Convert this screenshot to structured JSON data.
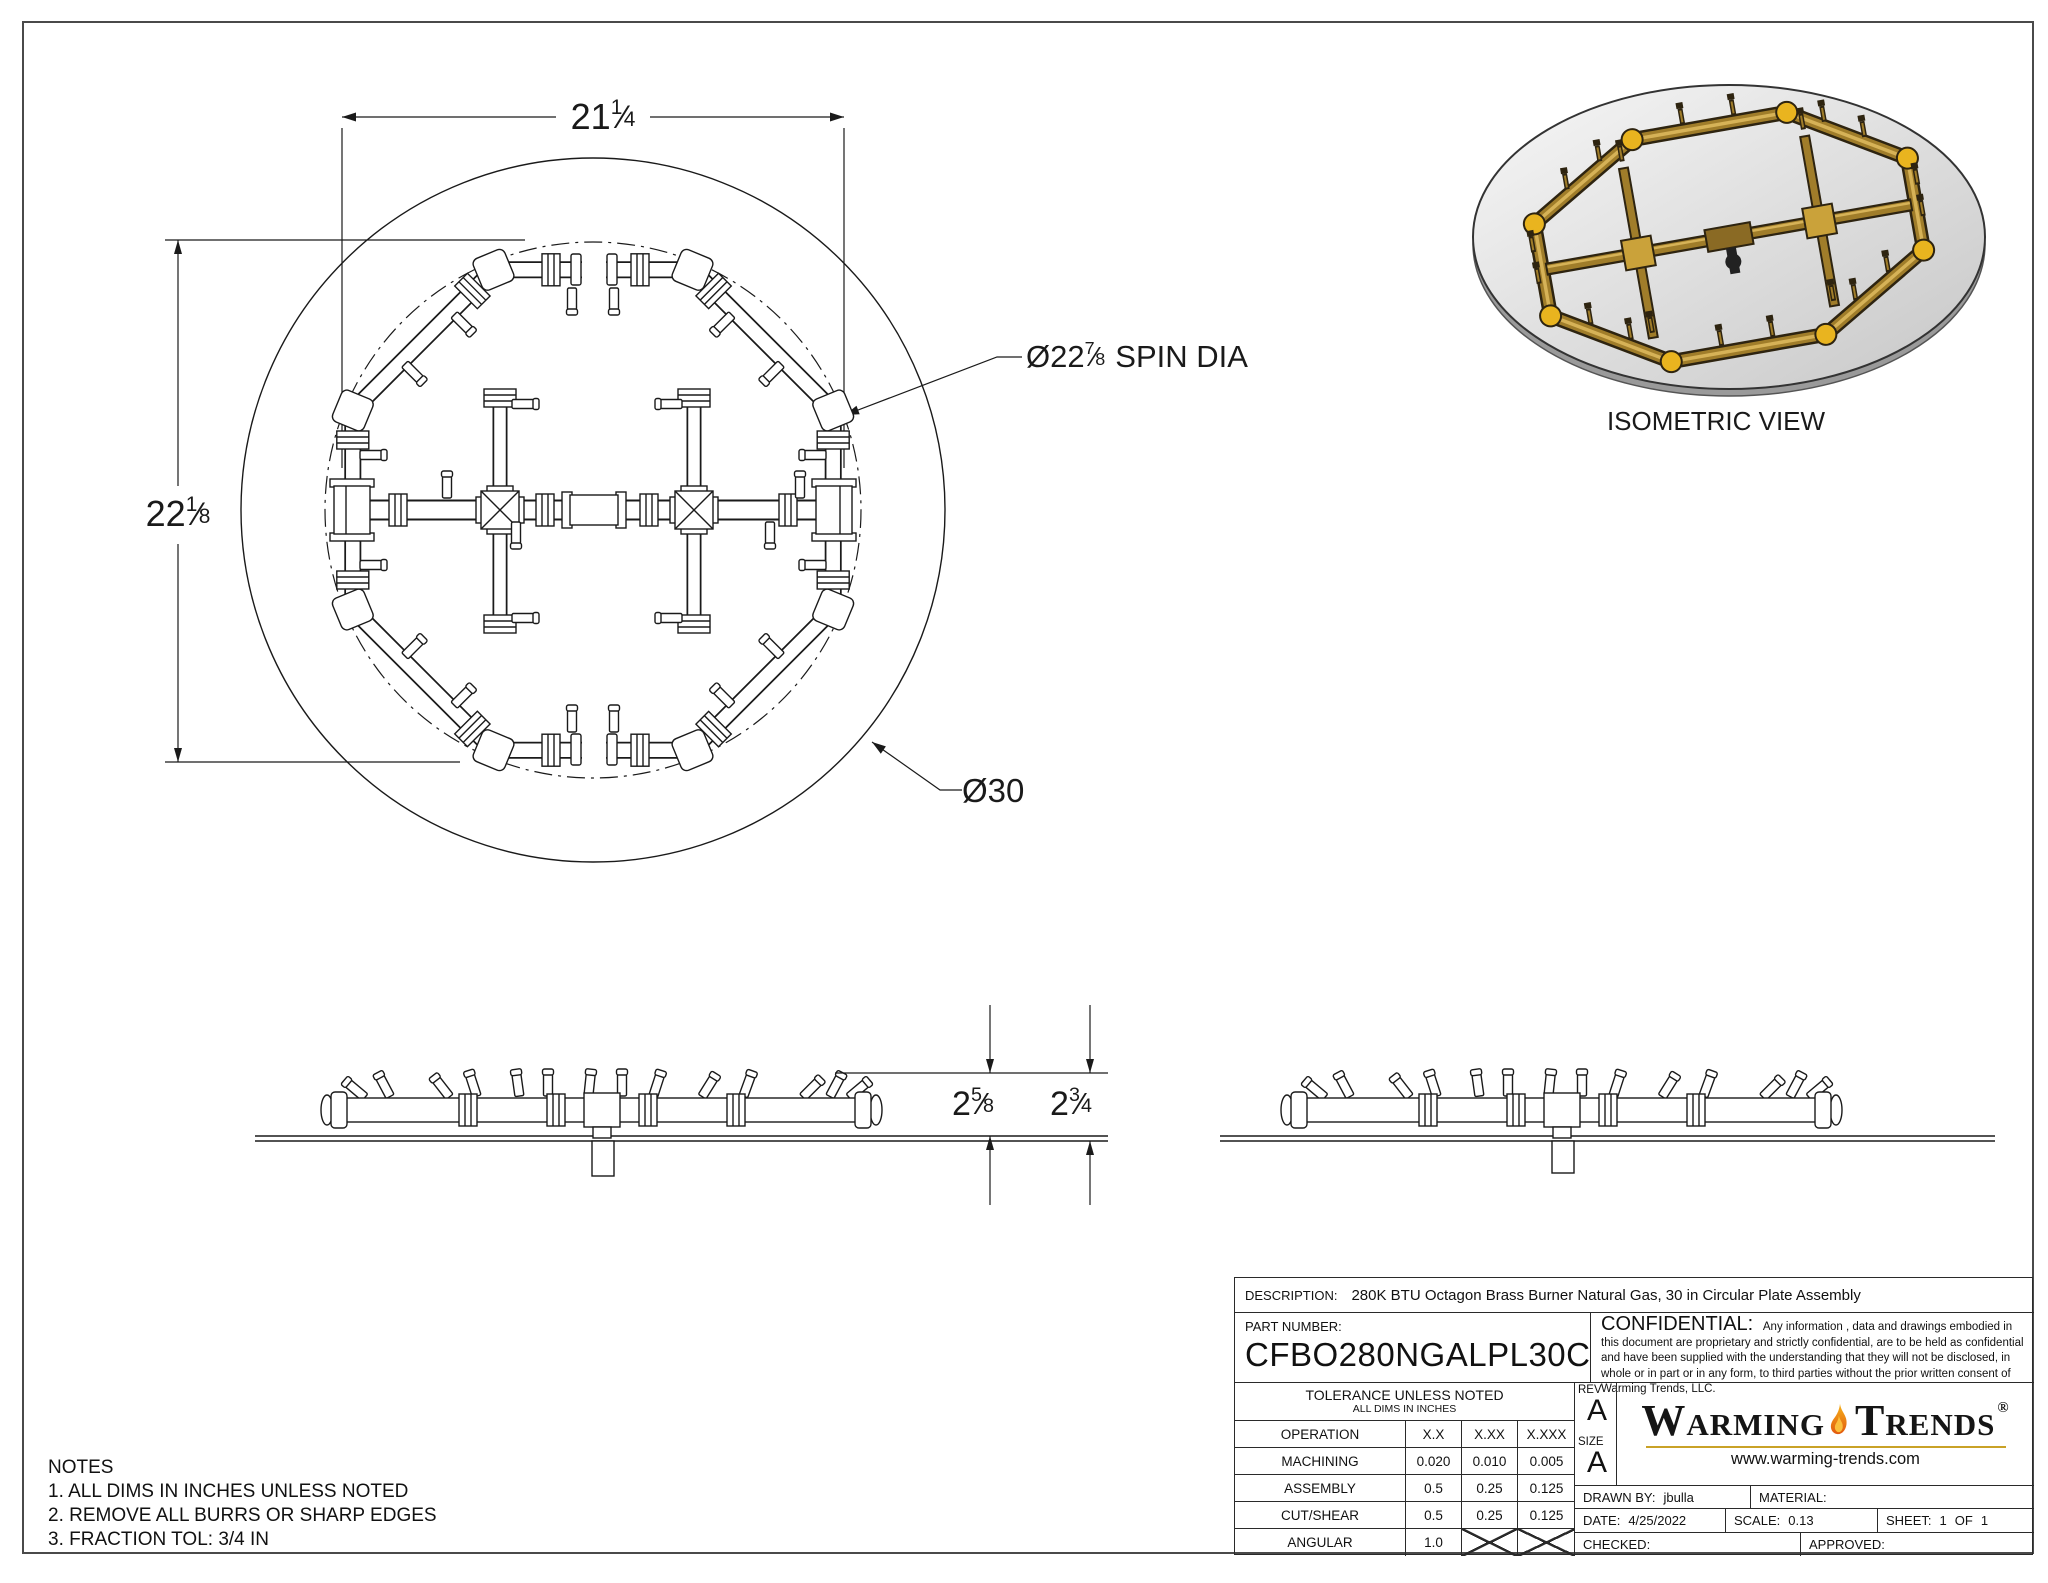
{
  "sheet": {
    "isometric_label": "ISOMETRIC VIEW",
    "notes": {
      "title": "NOTES",
      "items": [
        "1. ALL DIMS IN INCHES UNLESS NOTED",
        "2. REMOVE ALL BURRS OR SHARP EDGES",
        "3. FRACTION TOL: 3/4 IN"
      ]
    }
  },
  "dimensions": {
    "frac_slash": "⁄",
    "width": {
      "whole": "21",
      "num": "1",
      "den": "4"
    },
    "height": {
      "whole": "22",
      "num": "1",
      "den": "8"
    },
    "spin": {
      "prefix": "Ø",
      "whole": "22",
      "num": "7",
      "den": "8",
      "suffix": "SPIN DIA"
    },
    "plate": "Ø30",
    "burner_height": {
      "whole": "2",
      "num": "5",
      "den": "8"
    },
    "overall_height": {
      "whole": "2",
      "num": "3",
      "den": "4"
    }
  },
  "title_block": {
    "description_label": "DESCRIPTION:",
    "description": "280K BTU Octagon Brass Burner Natural Gas, 30 in Circular Plate Assembly",
    "part_number_label": "PART NUMBER:",
    "part_number": "CFBO280NGALPL30C",
    "confidential_label": "CONFIDENTIAL:",
    "confidential_text": "Any information , data and drawings embodied in this document are proprietary and strictly confidential, are to be held as confidential and have been supplied with the understanding that they will not be disclosed, in whole or in part or in any form, to third parties without the prior written consent of Warming Trends, LLC.",
    "tolerance": {
      "title": "TOLERANCE UNLESS NOTED",
      "subtitle": "ALL DIMS IN INCHES",
      "columns": [
        "OPERATION",
        "X.X",
        "X.XX",
        "X.XXX"
      ],
      "rows": [
        {
          "label": "MACHINING",
          "values": [
            "0.020",
            "0.010",
            "0.005"
          ]
        },
        {
          "label": "ASSEMBLY",
          "values": [
            "0.5",
            "0.25",
            "0.125"
          ]
        },
        {
          "label": "CUT/SHEAR",
          "values": [
            "0.5",
            "0.25",
            "0.125"
          ]
        },
        {
          "label": "ANGULAR",
          "values": [
            "1.0",
            "",
            ""
          ]
        }
      ]
    },
    "rev_label": "REV",
    "rev": "A",
    "size_label": "SIZE",
    "size": "A",
    "logo": {
      "word1": "Warming",
      "word2": "Trends",
      "registered": "®",
      "website": "www.warming-trends.com"
    },
    "drawn_by_label": "DRAWN BY:",
    "drawn_by": "jbulla",
    "material_label": "MATERIAL:",
    "material": "",
    "date_label": "DATE:",
    "date": "4/25/2022",
    "scale_label": "SCALE:",
    "scale": "0.13",
    "sheet_label": "SHEET:",
    "sheet_num": "1",
    "sheet_of": "OF",
    "sheet_total": "1",
    "checked_label": "CHECKED:",
    "checked": "",
    "approved_label": "APPROVED:",
    "approved": ""
  },
  "colors": {
    "line": "#1a1a1a",
    "brass": "#a07d2a",
    "brass_dark": "#2e2410",
    "brass_light": "#d6b257",
    "accent_yellow": "#e9b41f",
    "flame_orange": "#e2590e",
    "flame_amber": "#f6b21b",
    "gold_rule": "#c9a227",
    "plate_gray": "#d9d9d9"
  }
}
